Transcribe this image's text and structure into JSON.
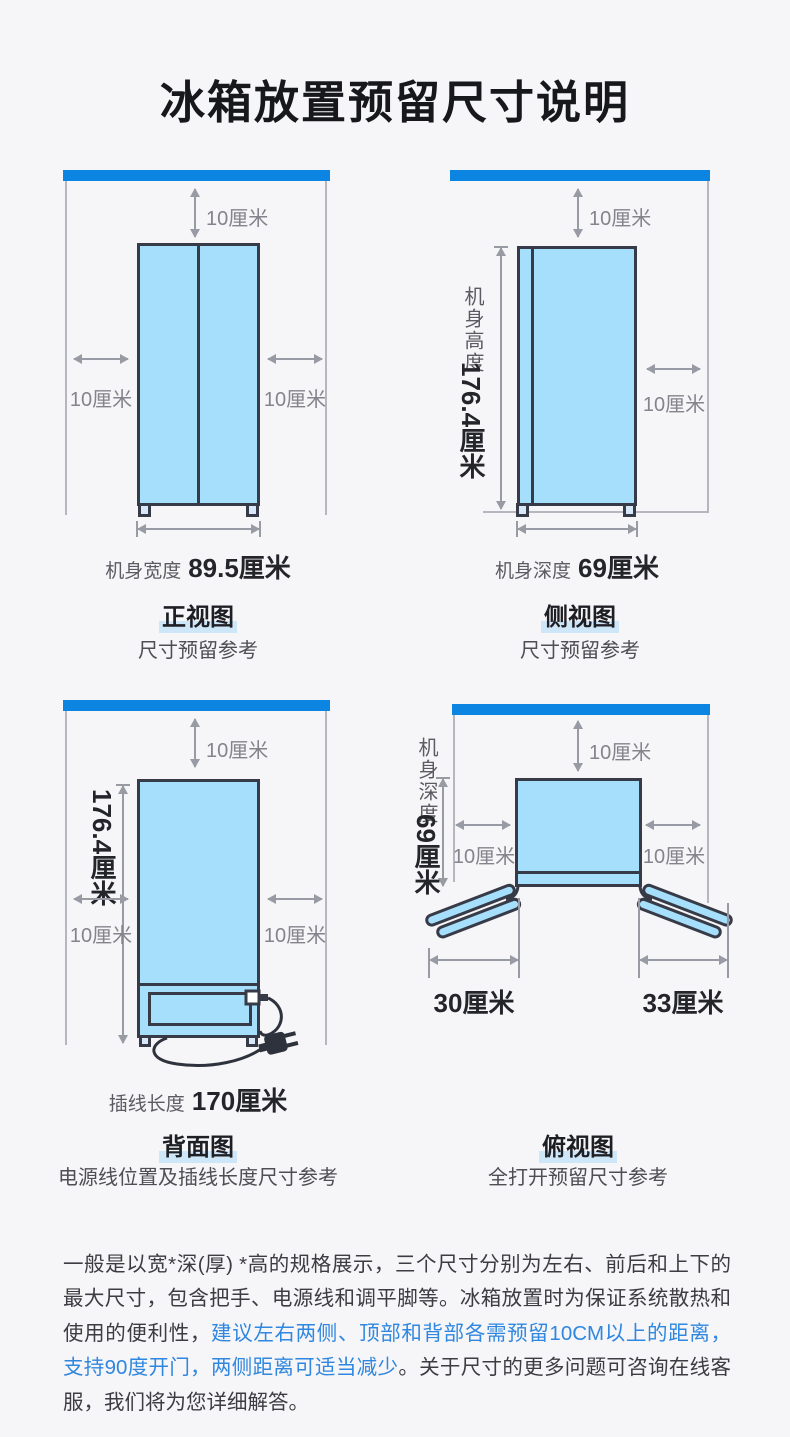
{
  "title": "冰箱放置预留尺寸说明",
  "diagrams": {
    "front": {
      "name": "正视图",
      "subtitle": "尺寸预留参考",
      "top_clearance": "10厘米",
      "left_clearance": "10厘米",
      "right_clearance": "10厘米",
      "width_label": "机身宽度",
      "width_value": "89.5厘米"
    },
    "side": {
      "name": "侧视图",
      "subtitle": "尺寸预留参考",
      "top_clearance": "10厘米",
      "right_clearance": "10厘米",
      "height_label": "机身高度",
      "height_value": "176.4厘米",
      "depth_label": "机身深度",
      "depth_value": "69厘米"
    },
    "back": {
      "name": "背面图",
      "subtitle": "电源线位置及插线长度尺寸参考",
      "top_clearance": "10厘米",
      "left_clearance": "10厘米",
      "right_clearance": "10厘米",
      "height_value": "176.4厘米",
      "cord_label": "插线长度",
      "cord_value": "170厘米"
    },
    "top": {
      "name": "俯视图",
      "subtitle": "全打开预留尺寸参考",
      "top_clearance": "10厘米",
      "left_clearance": "10厘米",
      "right_clearance": "10厘米",
      "depth_label": "机身深度",
      "depth_value": "69厘米",
      "left_door_clearance": "30厘米",
      "right_door_clearance": "33厘米"
    }
  },
  "footer": {
    "intro": "一般是以宽*深(厚) *高的规格展示，三个尺寸分别为左右、前后和上下的最大尺寸，包含把手、电源线和调平脚等。冰箱放置时为保证系统散热和使用的便利性，",
    "highlight": "建议左右两侧、顶部和背部各需预留10CM以上的距离，支持90度开门，两侧距离可适当减少",
    "outro": "。关于尺寸的更多问题可咨询在线客服，我们将为您详细解答。"
  },
  "colors": {
    "accent_blue": "#0b85e1",
    "fridge_fill": "#a6dffc",
    "fridge_outline": "#363b47",
    "link_blue": "#2f87e0",
    "name_highlight": "#cde6f8"
  }
}
